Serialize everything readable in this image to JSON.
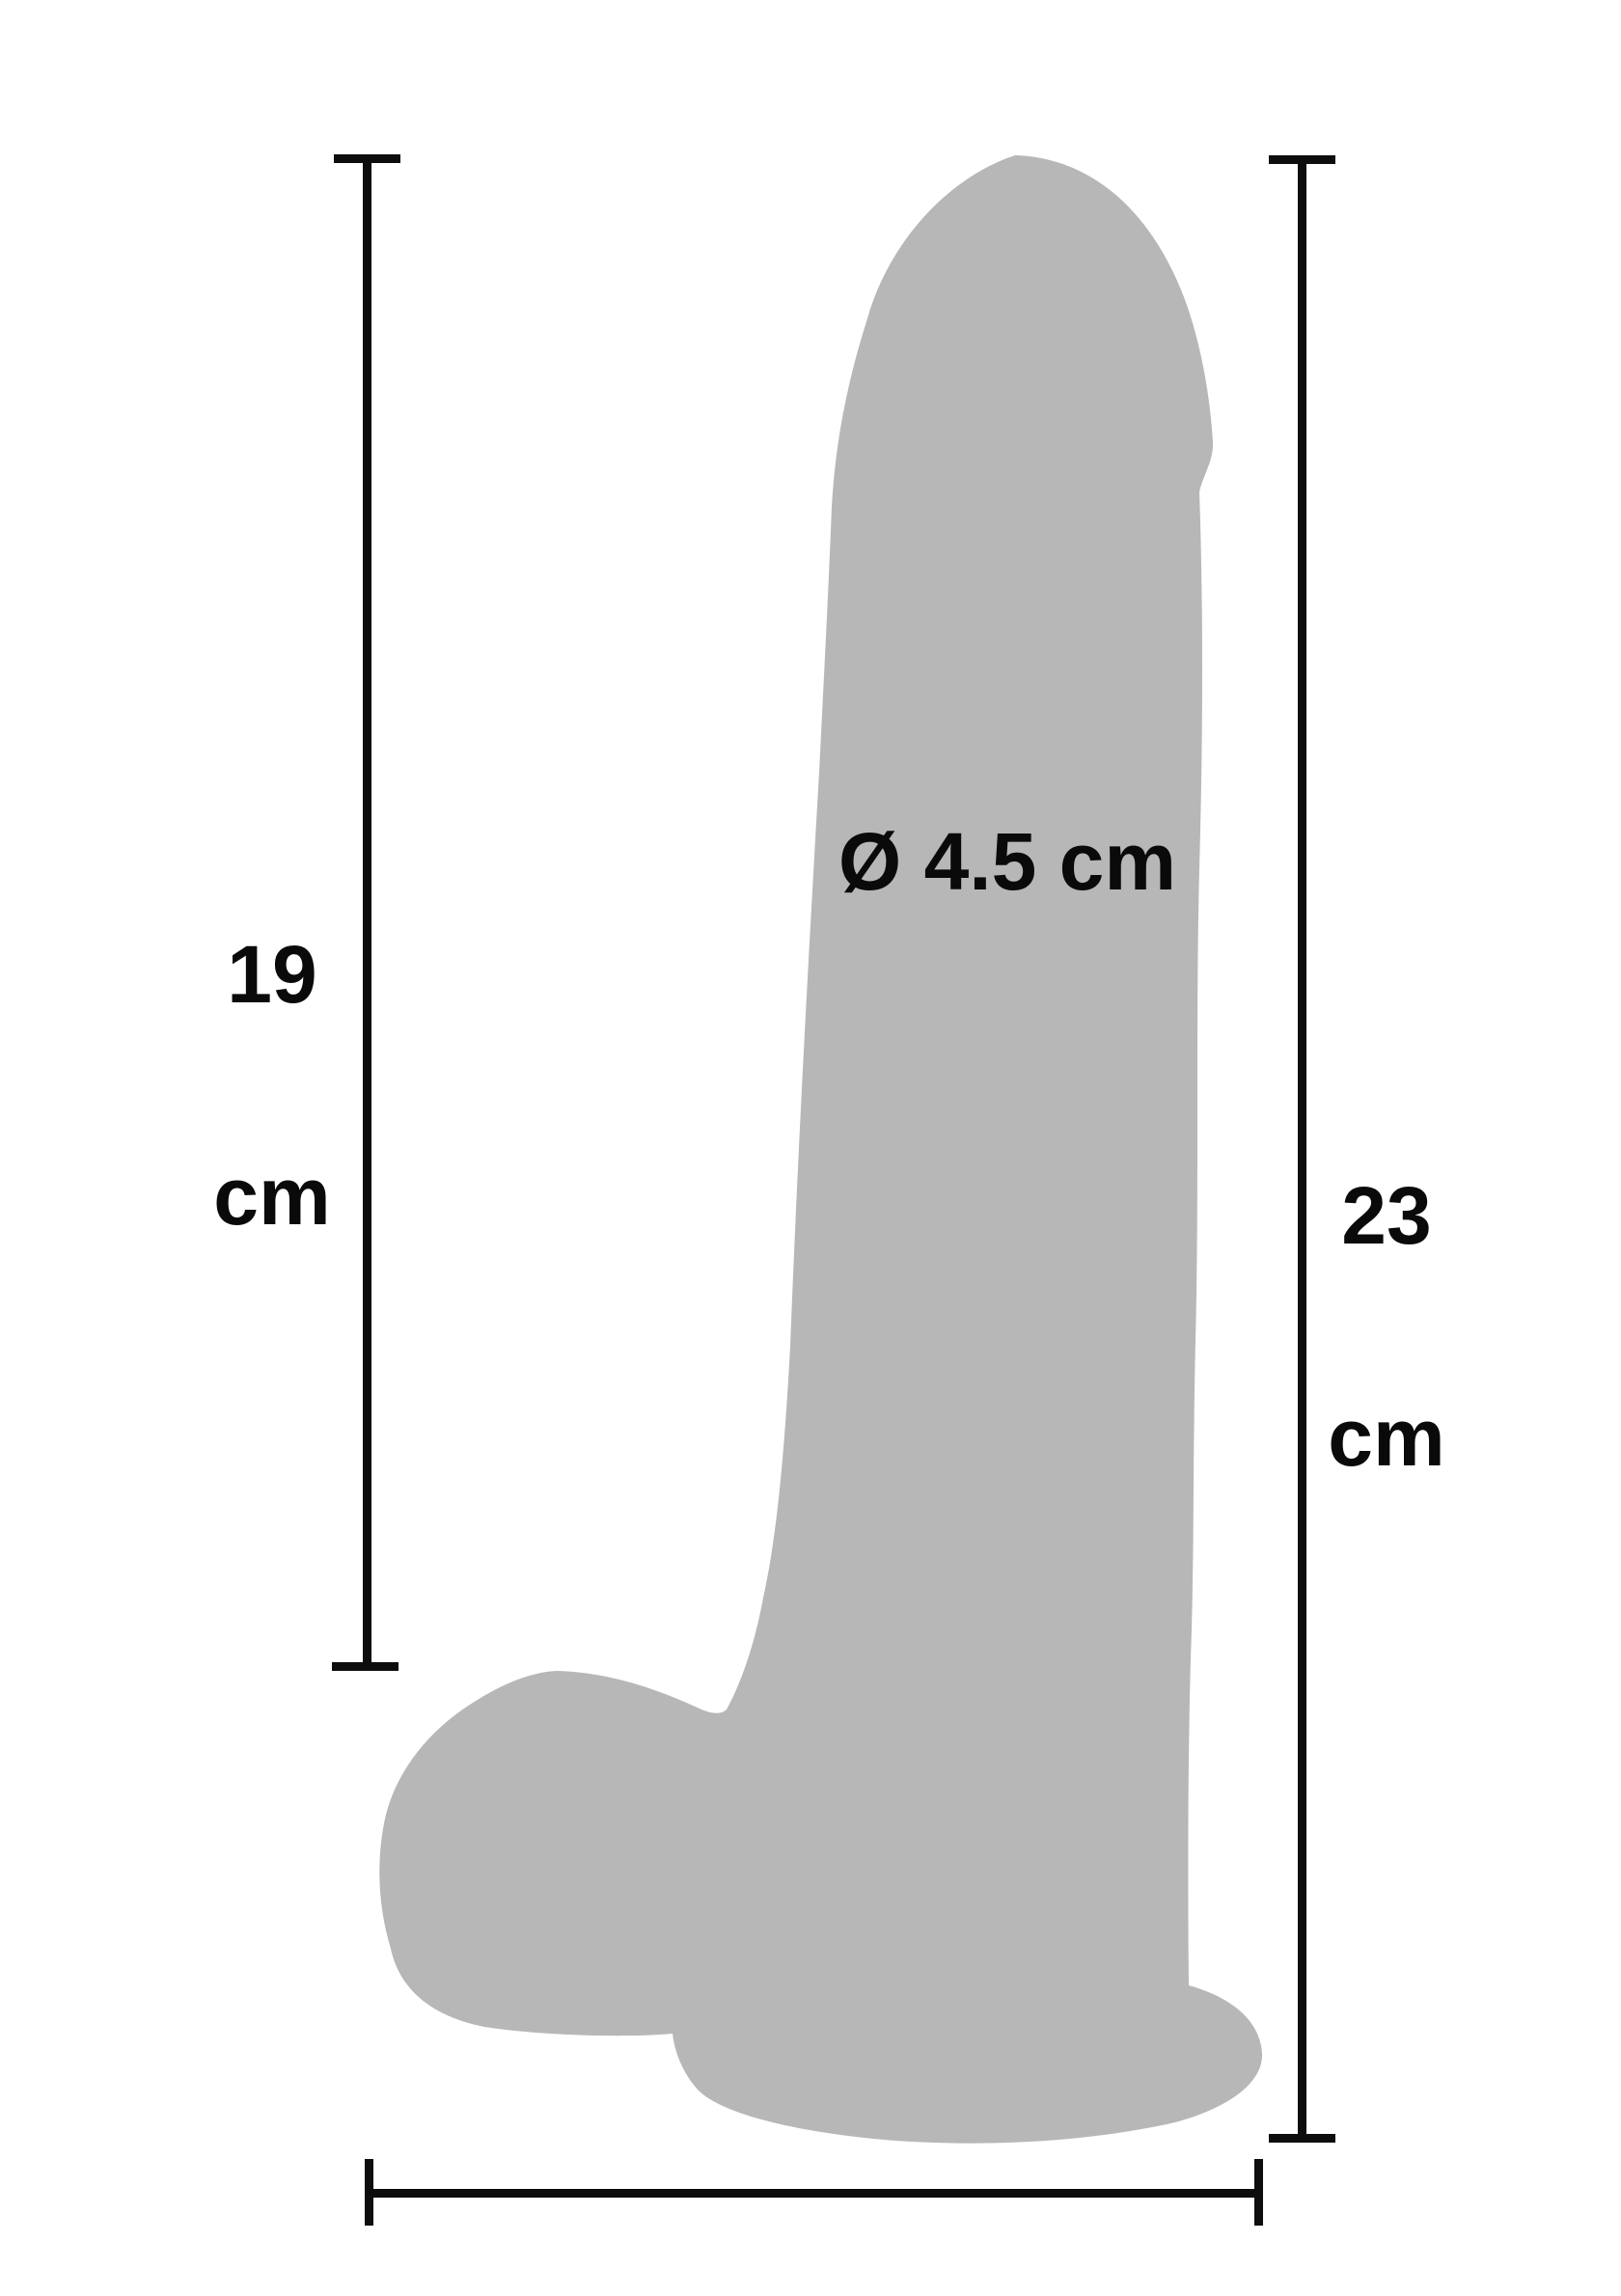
{
  "colors": {
    "silhouette": "#b7b7b7",
    "lines": "#0d0d0d",
    "text": "#0a0a0a",
    "background": "#ffffff"
  },
  "measurements": {
    "left_height": {
      "value": "19",
      "unit": "cm"
    },
    "right_height": {
      "value": "23",
      "unit": "cm"
    },
    "diameter": {
      "text": "Ø 4.5 cm"
    },
    "bottom_width": {
      "text": "10.5 cm"
    }
  }
}
